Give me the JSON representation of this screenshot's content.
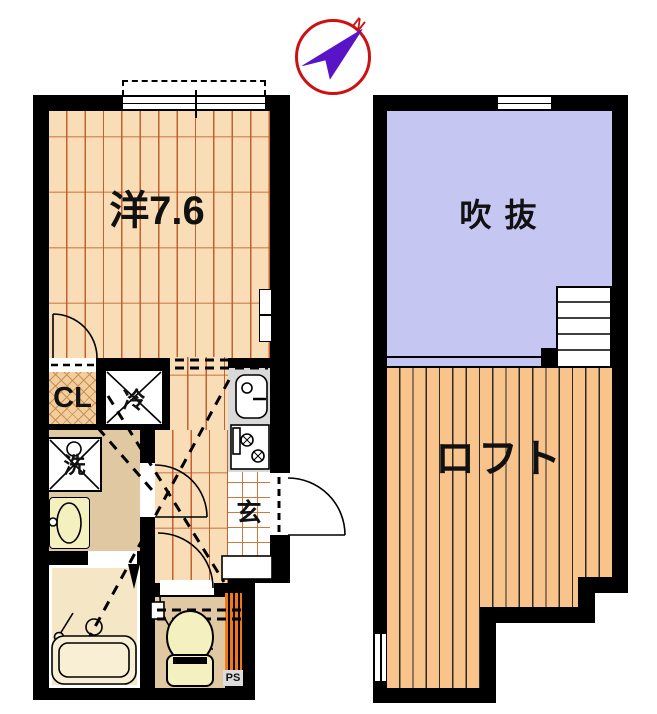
{
  "compass": {
    "north_label": "N"
  },
  "floor1": {
    "room_label": "洋7.6",
    "closet_label": "CL",
    "fridge_label": "冷",
    "washer_label": "洗",
    "entrance_label": "玄",
    "pipe_space_label": "PS"
  },
  "floor2": {
    "void_label": "吹 抜",
    "loft_label": "ロフト"
  },
  "colors": {
    "wall": "#000000",
    "wood_floor": "#F8DDB6",
    "void_purple": "#C6C6F2",
    "loft_orange": "#F9C38C",
    "hall_tan": "#E0C8A2",
    "bath_cream": "#F5E6C5",
    "fixture_cream": "#F5F0C0",
    "kitchen_gray": "#D9D9D9",
    "ps_orange": "#F07818",
    "compass_red": "#CC1111",
    "needle_purple": "#5A14C8"
  }
}
